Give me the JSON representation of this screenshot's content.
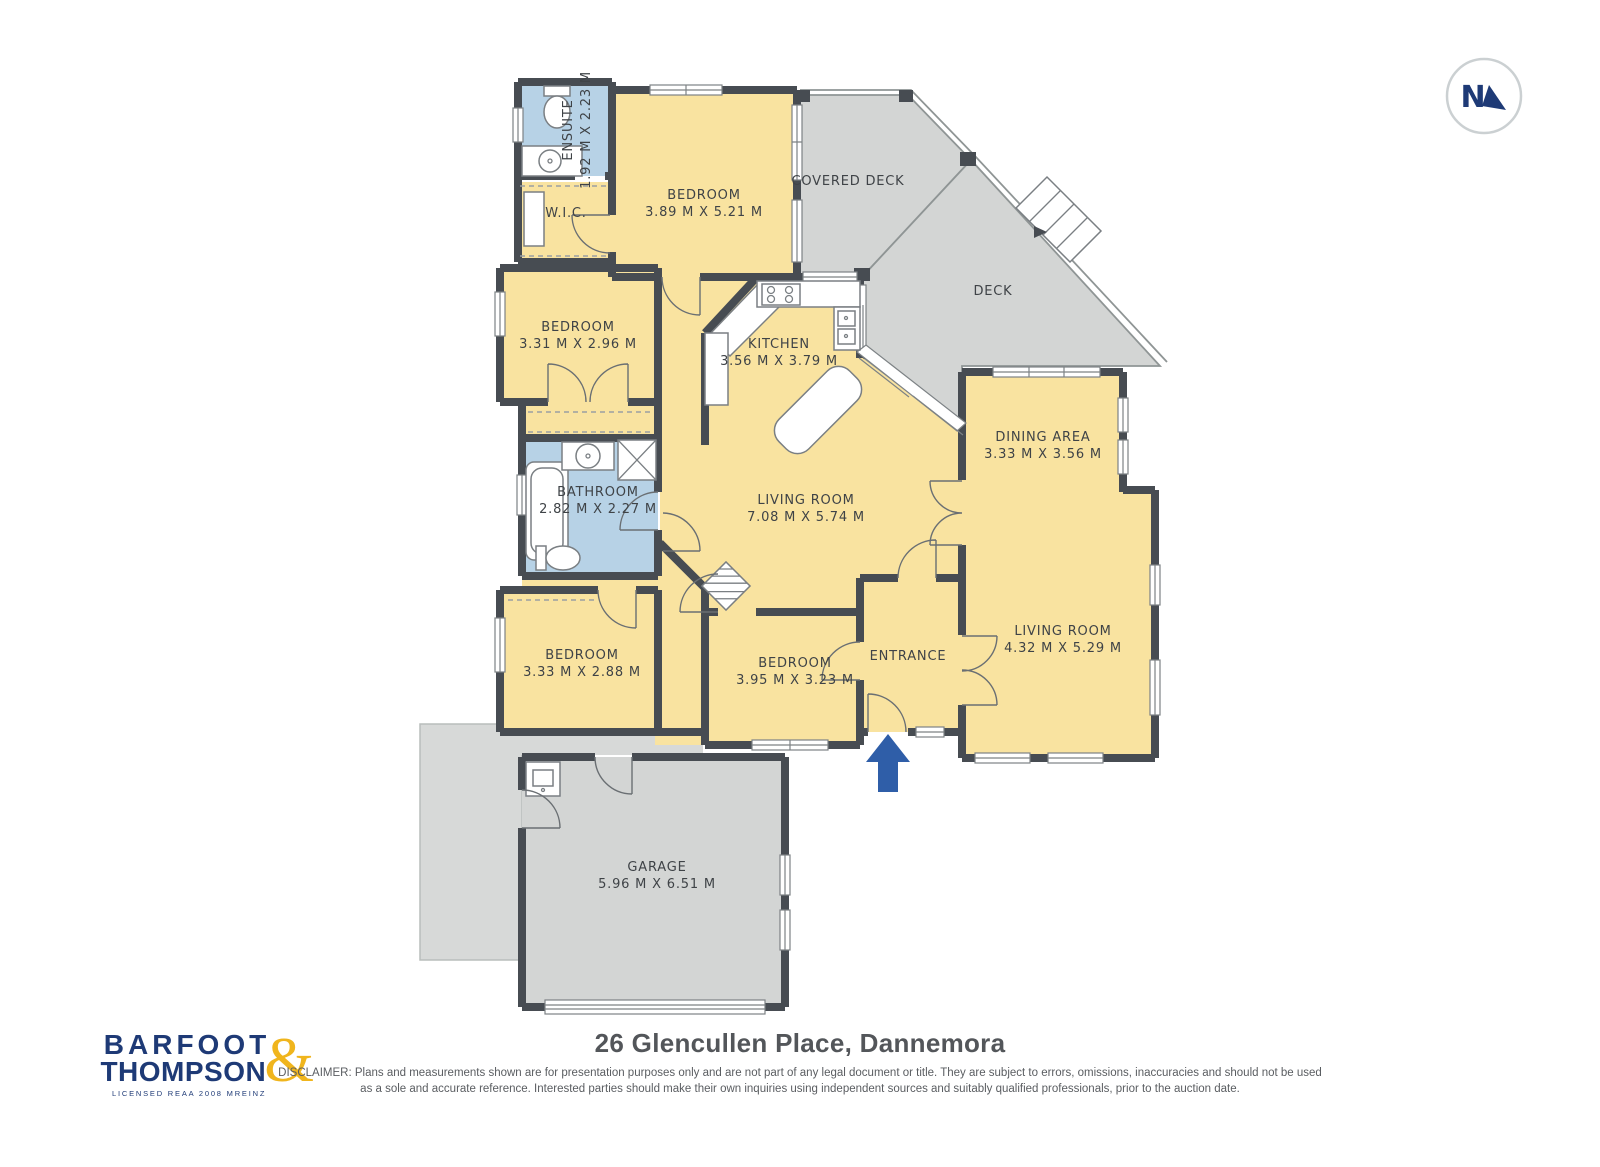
{
  "colors": {
    "room_yellow": "#F9E3A0",
    "room_blue": "#B7D2E6",
    "deck_gray": "#D3D5D4",
    "patio_gray": "#D7D9D8",
    "wall_dark": "#474C52",
    "line_gray": "#8F9595",
    "text_dark": "#3F4347",
    "logo_navy": "#1E3A76",
    "logo_gold": "#F0B51D",
    "arrow_blue": "#2F5EA8"
  },
  "compass": {
    "label": "N"
  },
  "rooms": [
    {
      "id": "ensuite",
      "name": "ENSUITE",
      "dims": "1.92 M X 2.23 M"
    },
    {
      "id": "wic",
      "name": "W.I.C."
    },
    {
      "id": "bedroom-top",
      "name": "BEDROOM",
      "dims": "3.89 M X 5.21 M"
    },
    {
      "id": "covered-deck",
      "name": "COVERED DECK"
    },
    {
      "id": "deck",
      "name": "DECK"
    },
    {
      "id": "bedroom-left",
      "name": "BEDROOM",
      "dims": "3.31 M X 2.96 M"
    },
    {
      "id": "kitchen",
      "name": "KITCHEN",
      "dims": "3.56 M X 3.79 M"
    },
    {
      "id": "dining-area",
      "name": "DINING AREA",
      "dims": "3.33 M X 3.56 M"
    },
    {
      "id": "bathroom",
      "name": "BATHROOM",
      "dims": "2.82 M X 2.27 M"
    },
    {
      "id": "living-main",
      "name": "LIVING ROOM",
      "dims": "7.08 M X 5.74 M"
    },
    {
      "id": "living-second",
      "name": "LIVING ROOM",
      "dims": "4.32 M X 5.29 M"
    },
    {
      "id": "bedroom-sw",
      "name": "BEDROOM",
      "dims": "3.33 M X 2.88 M"
    },
    {
      "id": "bedroom-south",
      "name": "BEDROOM",
      "dims": "3.95 M X 3.23 M"
    },
    {
      "id": "entrance",
      "name": "ENTRANCE"
    },
    {
      "id": "garage",
      "name": "GARAGE",
      "dims": "5.96 M X 6.51 M"
    }
  ],
  "footer": {
    "title": "26 Glencullen Place, Dannemora",
    "disclaimer_line1": "DISCLAIMER: Plans and measurements shown are for presentation purposes only and are not part of any legal document or title. They are subject to errors, omissions, inaccuracies and should not be used",
    "disclaimer_line2": "as a sole and accurate reference. Interested parties should make their own inquiries using independent sources and suitably qualified professionals, prior to the auction date."
  },
  "logo": {
    "line1": "BARFOOT",
    "line2": "THOMPSON",
    "ampersand": "&",
    "licence": "LICENSED REAA 2008 MREINZ"
  }
}
